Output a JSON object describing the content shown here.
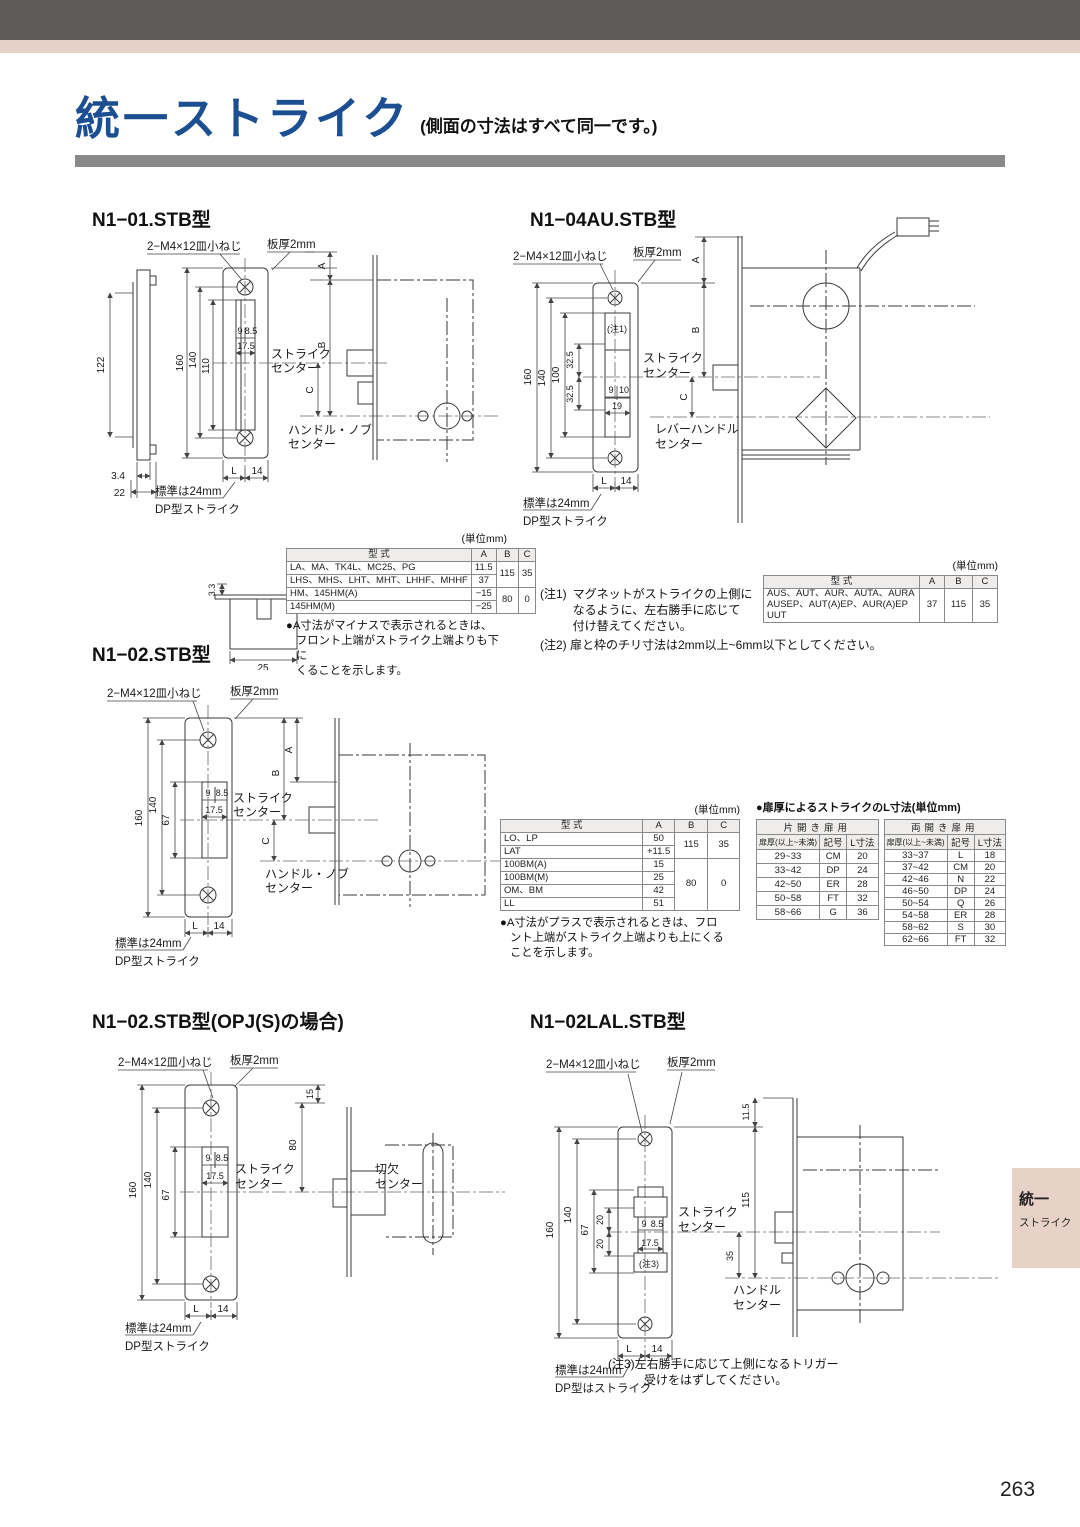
{
  "page": {
    "title": "統一ストライク",
    "subtitle": "(側面の寸法はすべて同一です。)",
    "page_number": "263",
    "side_tab": {
      "line1": "統一",
      "line2": "ストライク"
    },
    "colors": {
      "title_blue": "#1c4e92",
      "bar_gray": "#8a8a8a",
      "top_dark": "#5e5b59",
      "top_pink": "#e6d1c8",
      "tab_pink": "#e8d1c6"
    }
  },
  "headings": {
    "n101": "N1−01.STB型",
    "n104": "N1−04AU.STB型",
    "n102": "N1−02.STB型",
    "n102opj": "N1−02.STB型(OPJ(S)の場合)",
    "n102lal": "N1−02LAL.STB型"
  },
  "common": {
    "screw": "2−M4×12皿小ねじ",
    "plate": "板厚2mm",
    "std": "標準は24mm",
    "dp": "DP型ストライク",
    "strike1": "ストライク",
    "strike2": "センター",
    "L": "L",
    "n14": "14",
    "A": "A",
    "B": "B",
    "C": "C"
  },
  "n101": {
    "d122": "122",
    "d160": "160",
    "d140": "140",
    "d110": "110",
    "d9": "9",
    "d85": "8.5",
    "d175": "17.5",
    "handle1": "ハンドル・ノブ",
    "handle2": "センター",
    "d34": "3.4",
    "d22": "22",
    "d33": "3.3",
    "d25": "25"
  },
  "n104": {
    "d160": "160",
    "d140": "140",
    "d100": "100",
    "d325a": "32.5",
    "d325b": "32.5",
    "d9": "9",
    "d10": "10",
    "d19": "19",
    "note": "(注1)",
    "lever1": "レバーハンドル",
    "lever2": "センター"
  },
  "n102": {
    "d160": "160",
    "d140": "140",
    "d67": "67",
    "d9": "9",
    "d85": "8.5",
    "d175": "17.5",
    "handle1": "ハンドル・ノブ",
    "handle2": "センター"
  },
  "n102opj": {
    "d160": "160",
    "d140": "140",
    "d67": "67",
    "d9": "9",
    "d85": "8.5",
    "d175": "17.5",
    "d15": "15",
    "d80": "80",
    "notch1": "切欠",
    "notch2": "センター"
  },
  "n102lal": {
    "d115s": "11.5",
    "d115": "115",
    "d160": "160",
    "d140": "140",
    "d67": "67",
    "d20a": "20",
    "d20b": "20",
    "d9": "9",
    "d85": "8.5",
    "d175": "17.5",
    "note": "(注3)",
    "d35": "35",
    "handle1": "ハンドル",
    "handle2": "センター",
    "dp": "DP型はストライク"
  },
  "tables": {
    "t1": {
      "unit": "(単位mm)",
      "h": [
        "型 式",
        "A",
        "B",
        "C"
      ],
      "rows": [
        [
          "LA、MA、TK4L、MC25、PG",
          "11.5"
        ],
        [
          "LHS、MHS、LHT、MHT、LHHF、MHHF",
          "37"
        ],
        [
          "HM、145HM(A)",
          "−15"
        ],
        [
          "145HM(M)",
          "−25"
        ]
      ],
      "b1": "115",
      "c1": "35",
      "b2": "80",
      "c2": "0",
      "note": [
        "●A寸法がマイナスで表示されるときは、",
        "フロント上端がストライク上端よりも下に",
        "くることを示します。"
      ]
    },
    "t2": {
      "unit": "(単位mm)",
      "h": [
        "型 式",
        "A",
        "B",
        "C"
      ],
      "model": [
        "AUS、AUT、AUR、AUTA、AURA",
        "AUSEP、AUT(A)EP、AUR(A)EP",
        "UUT"
      ],
      "a": "37",
      "b": "115",
      "c": "35"
    },
    "t3": {
      "unit": "(単位mm)",
      "h": [
        "型 式",
        "A",
        "B",
        "C"
      ],
      "rows": [
        [
          "LO、LP",
          "50"
        ],
        [
          "LAT",
          "+11.5"
        ],
        [
          "100BM(A)",
          "15"
        ],
        [
          "100BM(M)",
          "25"
        ],
        [
          "OM、BM",
          "42"
        ],
        [
          "LL",
          "51"
        ]
      ],
      "b1": "115",
      "c1": "35",
      "b2": "80",
      "c2": "0",
      "note": [
        "●A寸法がプラスで表示されるときは、フロ",
        "ント上端がストライク上端よりも上にくる",
        "ことを示します。"
      ]
    },
    "lt": {
      "title": "●扉厚によるストライクのL寸法(単位mm)",
      "left": {
        "head": "片開き扉用",
        "cols": [
          "扉厚(以上~未満)",
          "記号",
          "L寸法"
        ],
        "rows": [
          [
            "29~33",
            "CM",
            "20"
          ],
          [
            "33~42",
            "DP",
            "24"
          ],
          [
            "42~50",
            "ER",
            "28"
          ],
          [
            "50~58",
            "FT",
            "32"
          ],
          [
            "58~66",
            "G",
            "36"
          ]
        ]
      },
      "right": {
        "head": "両開き扉用",
        "cols": [
          "扉厚(以上~未満)",
          "記号",
          "L寸法"
        ],
        "rows": [
          [
            "33~37",
            "L",
            "18"
          ],
          [
            "37~42",
            "CM",
            "20"
          ],
          [
            "42~46",
            "N",
            "22"
          ],
          [
            "46~50",
            "DP",
            "24"
          ],
          [
            "50~54",
            "Q",
            "26"
          ],
          [
            "54~58",
            "ER",
            "28"
          ],
          [
            "58~62",
            "S",
            "30"
          ],
          [
            "62~66",
            "FT",
            "32"
          ]
        ]
      }
    }
  },
  "notes": {
    "n1_label": "(注1)",
    "n1": [
      "マグネットがストライクの上側に",
      "なるように、左右勝手に応じて",
      "付け替えてください。"
    ],
    "n2": "(注2) 扉と枠のチリ寸法は2mm以上~6mm以下としてください。",
    "n3": [
      "(注3)左右勝手に応じて上側になるトリガー",
      "受けをはずしてください。"
    ]
  }
}
